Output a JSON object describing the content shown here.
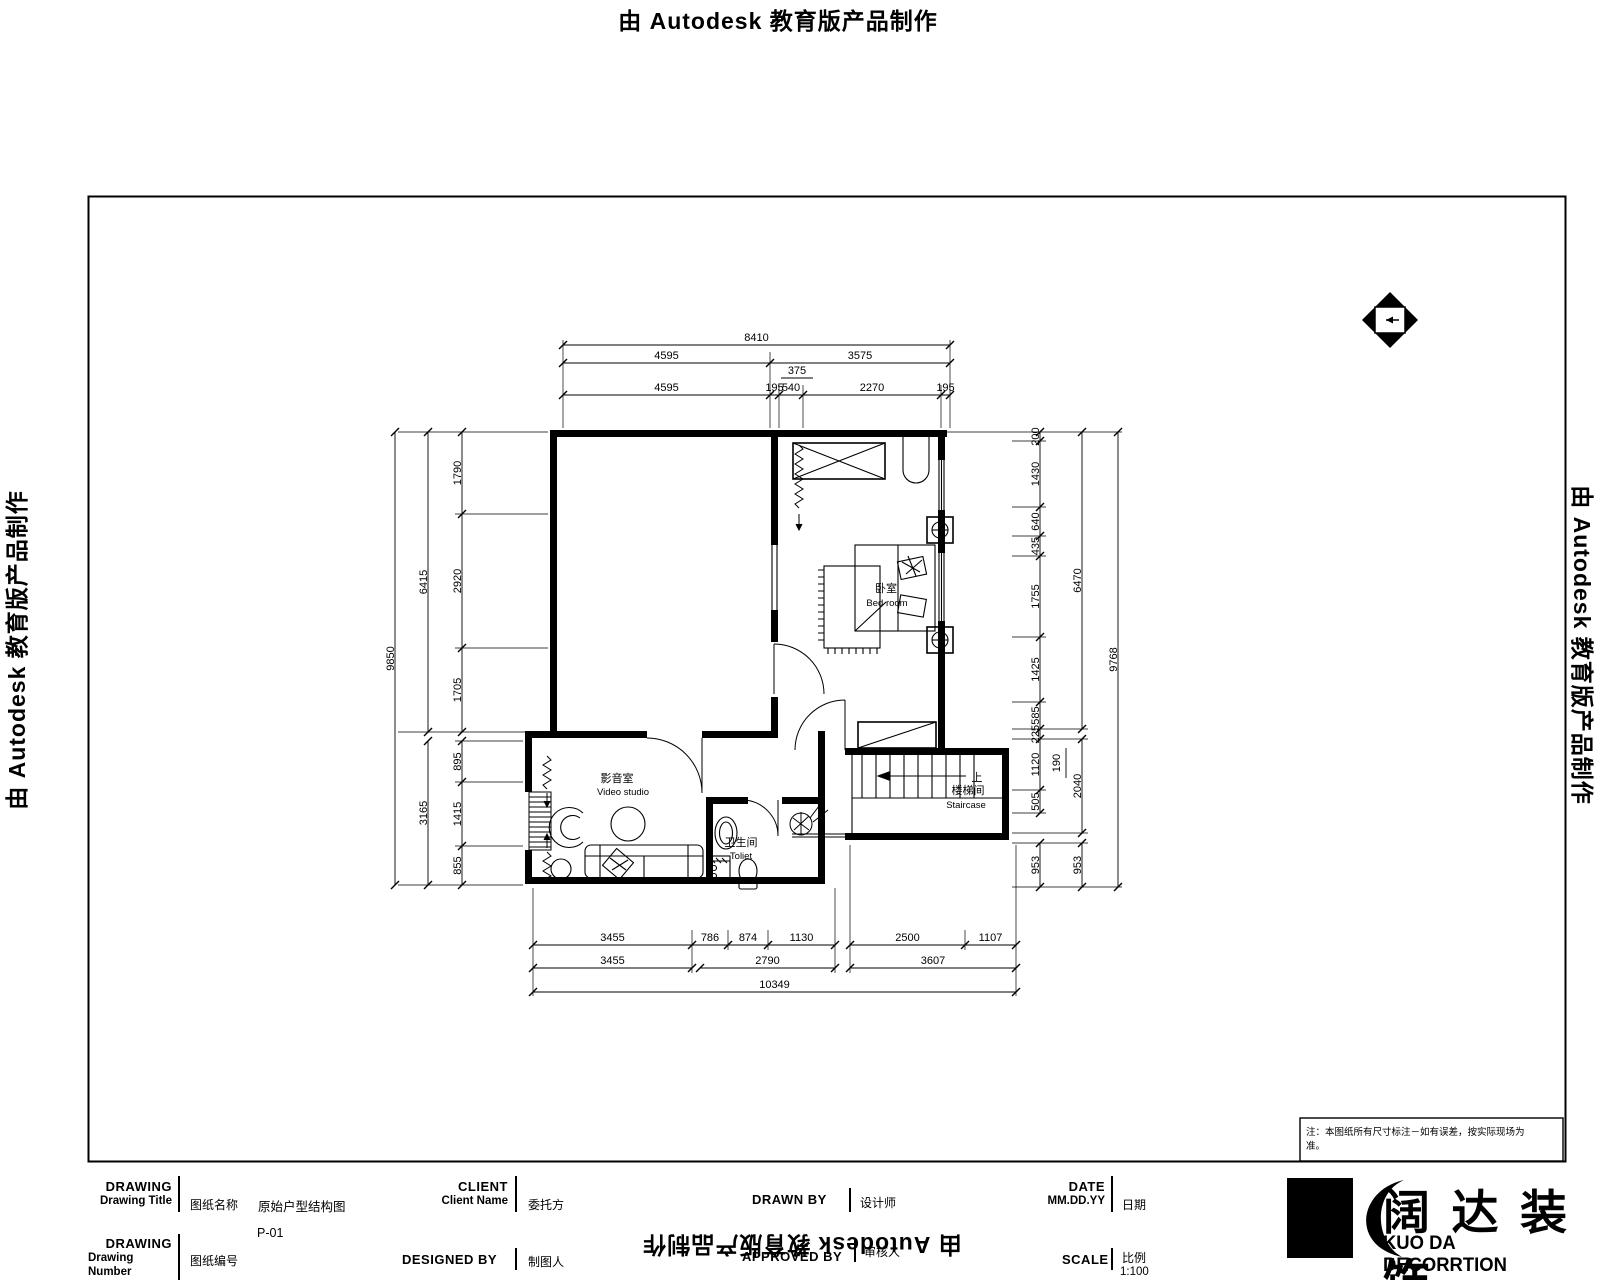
{
  "stamp": {
    "text": "由 Autodesk 教育版产品制作"
  },
  "plan": {
    "rooms": {
      "bedroom_zh": "卧室",
      "bedroom_en": "Bed room",
      "video_zh": "影音室",
      "video_en": "Video studio",
      "toilet_zh": "卫生间",
      "toilet_en": "Toliet",
      "stair_zh": "楼梯间",
      "stair_en": "Staircase",
      "stair_up": "上"
    },
    "dims": {
      "top": {
        "row1": [
          "8410"
        ],
        "row2": [
          "4595",
          "3575"
        ],
        "row3": [
          "4595",
          "195",
          "540",
          "2270",
          "195"
        ]
      },
      "left": {
        "row1": [
          "9850"
        ],
        "row2a": [
          "6415"
        ],
        "row2b": [
          "3165"
        ],
        "row3a": [
          "1790",
          "2920",
          "1705"
        ],
        "row3b": [
          "895",
          "1415",
          "855"
        ]
      },
      "right": {
        "outer": [
          "9768"
        ],
        "mid_a": [
          "6470"
        ],
        "mid_b": [
          "2040"
        ],
        "mid_c": [
          "953"
        ],
        "inner_a": [
          "200",
          "1430",
          "640",
          "435",
          "1755",
          "1425",
          "585",
          "225",
          "1120",
          "505"
        ],
        "inner_b": [
          "953"
        ]
      },
      "bottom": {
        "row1a": [
          "3455",
          "786",
          "874",
          "1130"
        ],
        "row1b": [
          "2500",
          "1107"
        ],
        "row2a": [
          "3455"
        ],
        "row2b": [
          "2790"
        ],
        "row2c": [
          "3607"
        ],
        "row3": [
          "10349"
        ]
      }
    },
    "small_top": "375",
    "small_right": "190"
  },
  "note": {
    "line1": "注：本图纸所有尺寸标注－如有误差，按实际现场为",
    "line2": "准。"
  },
  "titleblock": {
    "drawing_title": {
      "en1": "DRAWING",
      "en2": "Drawing Title",
      "zh": "图纸名称",
      "value": "原始户型结构图"
    },
    "drawing_number": {
      "en1": "DRAWING",
      "en2": "Drawing",
      "en3": "Number",
      "zh": "图纸编号",
      "value": "P-01"
    },
    "client": {
      "en1": "CLIENT",
      "en2": "Client Name",
      "zh": "委托方"
    },
    "drawn_by": {
      "en": "DRAWN  BY",
      "zh": "设计师"
    },
    "designed_by": {
      "en": "DESIGNED BY",
      "zh": "制图人"
    },
    "approved_by": {
      "en": "APPROVED BY",
      "zh": "审核人"
    },
    "date": {
      "en1": "DATE",
      "en2": "MM.DD.YY",
      "zh": "日期"
    },
    "scale": {
      "en": "SCALE",
      "zh": "比例",
      "value": "1:100"
    }
  },
  "logo": {
    "cn": "阔达装饰",
    "en": "KUO DA DECORRTION"
  }
}
